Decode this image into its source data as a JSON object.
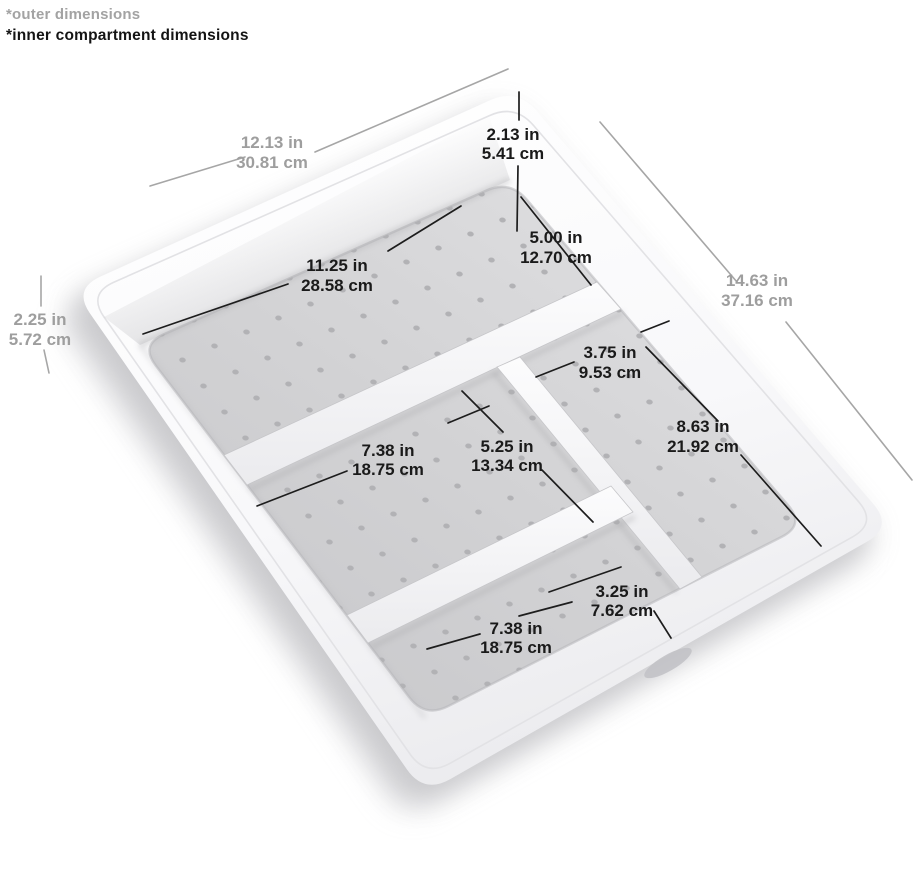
{
  "header": {
    "outer_note": "*outer dimensions",
    "inner_note": "*inner compartment dimensions"
  },
  "tray": {
    "compartment_count": 4,
    "texture": "dotted-liner"
  },
  "dims": {
    "outer_length": {
      "in": "12.13 in",
      "cm": "30.81 cm"
    },
    "outer_width": {
      "in": "14.63 in",
      "cm": "37.16 cm"
    },
    "outer_height": {
      "in": "2.25 in",
      "cm": "5.72 cm"
    },
    "inner_depth": {
      "in": "2.13 in",
      "cm": "5.41 cm"
    },
    "top_compartment_width": {
      "in": "5.00 in",
      "cm": "12.70 cm"
    },
    "top_compartment_length": {
      "in": "11.25 in",
      "cm": "28.58 cm"
    },
    "middle_compartment_length": {
      "in": "7.38 in",
      "cm": "18.75 cm"
    },
    "middle_compartment_width": {
      "in": "5.25 in",
      "cm": "13.34 cm"
    },
    "right_compartment_width": {
      "in": "3.75 in",
      "cm": "9.53 cm"
    },
    "right_compartment_length": {
      "in": "8.63 in",
      "cm": "21.92 cm"
    },
    "bottom_compartment_width": {
      "in": "3.25 in",
      "cm": "7.62 cm"
    },
    "bottom_compartment_length": {
      "in": "7.38 in",
      "cm": "18.75 cm"
    }
  },
  "colors": {
    "background": "#ffffff",
    "tray_body": "#f7f7f9",
    "floor_liner": "#d2d2d4",
    "liner_dots": "#b2b2b5",
    "inner_label": "#1a1a1a",
    "outer_label": "#9e9e9e",
    "shadow": "#c4c4c7"
  }
}
